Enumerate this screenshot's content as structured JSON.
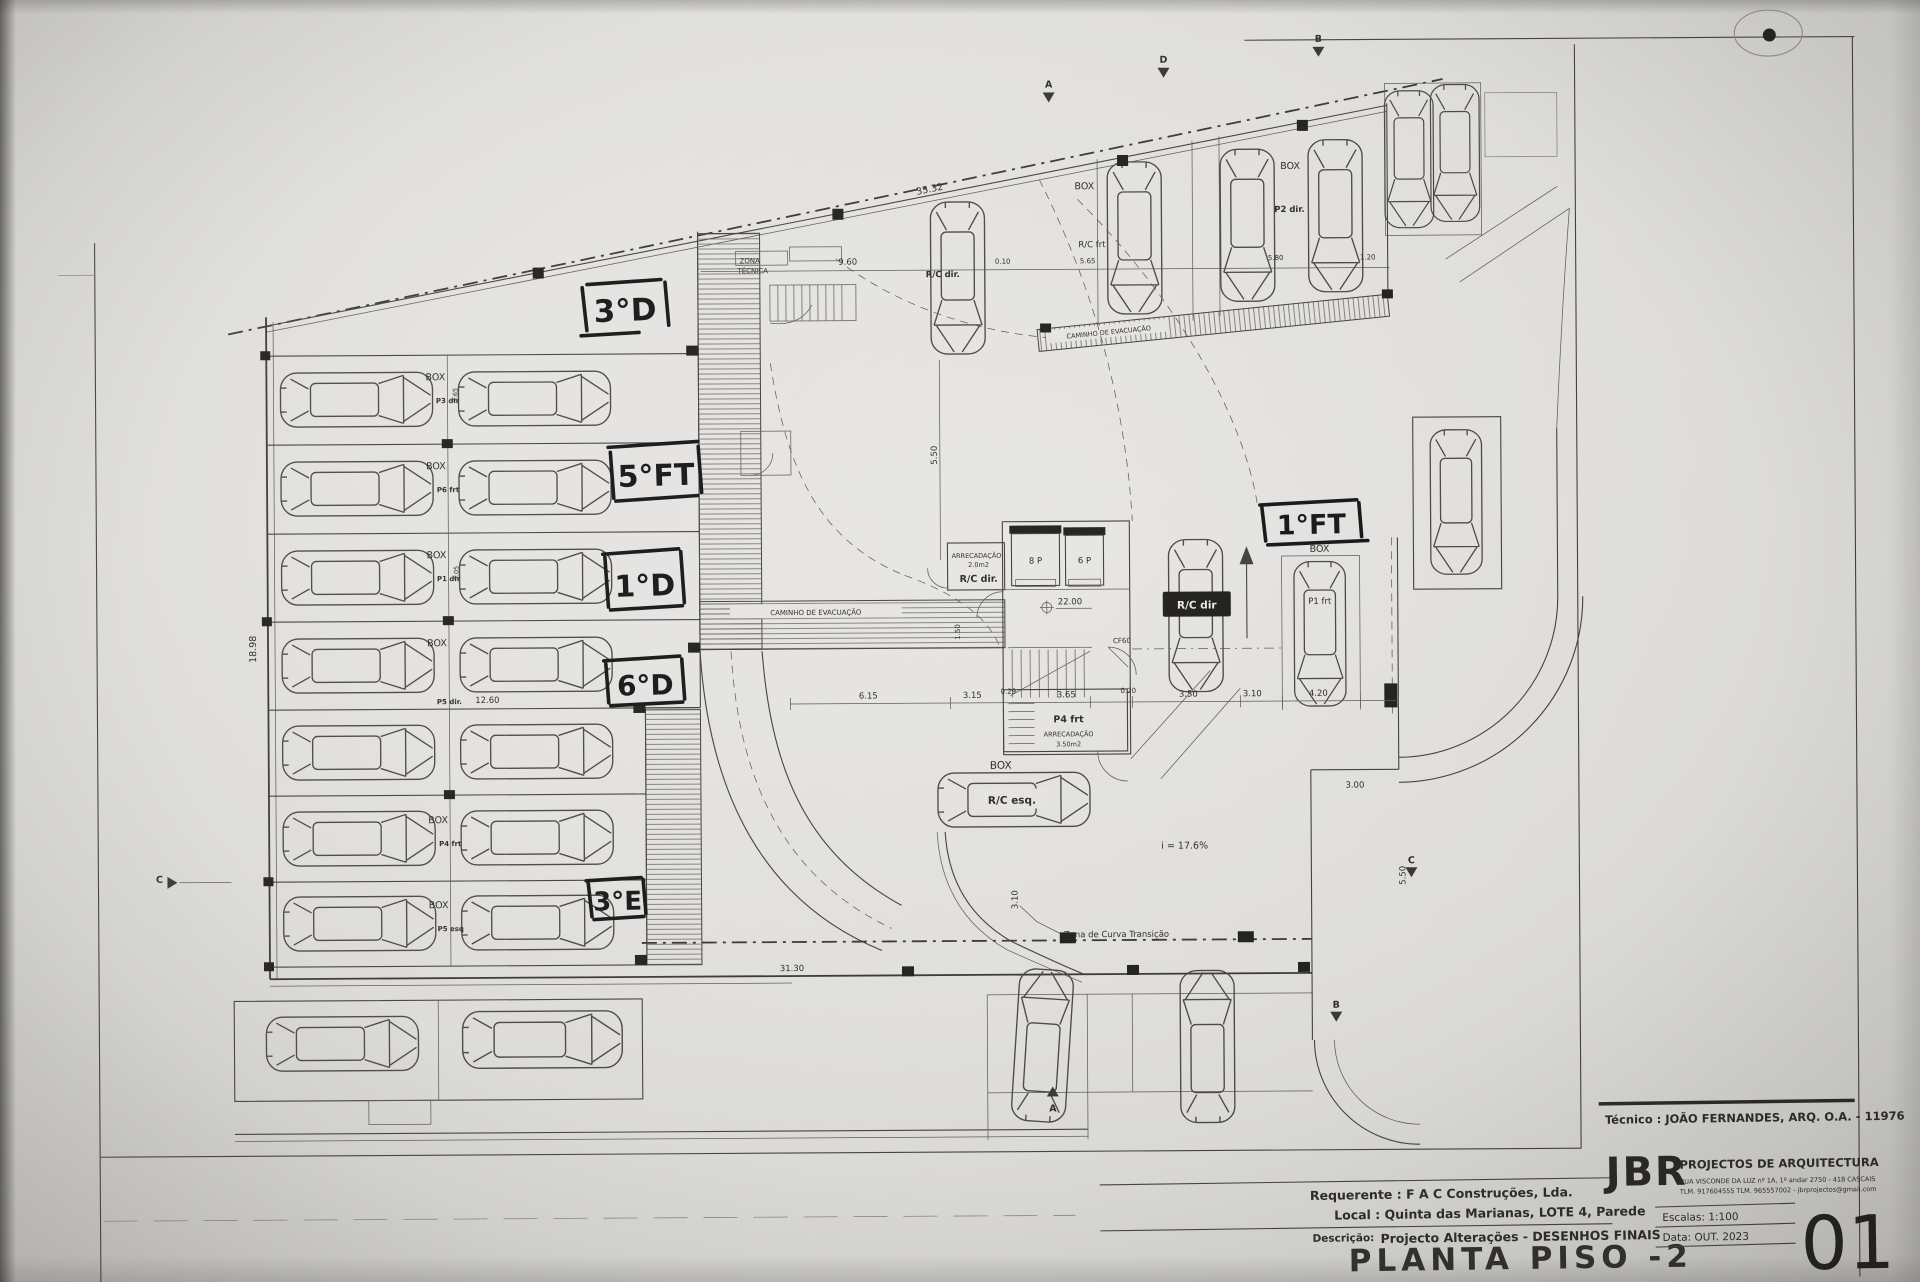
{
  "title_block": {
    "tecnico": "Técnico : JOÃO FERNANDES, ARQ.   O.A. - 11976",
    "firm_name": "JBR",
    "firm_subtitle": "PROJECTOS DE ARQUITECTURA",
    "firm_address": "RUA VISCONDE DA LUZ nº 1A, 1º andar  2750 - 418  CASCAIS",
    "firm_contacts": "TLM. 917604555  TLM. 965557002 - jbrprojectos@gmail.com",
    "requerente": "Requerente : F A C  Construções, Lda.",
    "local": "Local : Quinta das Marianas, LOTE 4, Parede",
    "descricao_label": "Descrição:",
    "descricao": "Projecto Alterações - DESENHOS FINAIS",
    "sheet_title": "PLANTA PISO -2",
    "escalas": "Escalas:  1:100",
    "data": "Data: OUT.  2023",
    "sheet_number": "01"
  },
  "handwritten": {
    "n1": "3°D",
    "n2": "5°FT",
    "n3": "1°D",
    "n4": "6°D",
    "n5": "3°E",
    "n6": "1°FT"
  },
  "labels": {
    "box": "BOX",
    "zona1": "ZONA",
    "zona2": "TÉCNICA",
    "caminho": "CAMINHO  DE  EVACUAÇÃO",
    "rc_dir": "R/C dir.",
    "rc_frt": "R/C frt",
    "p2_dir": "P2 dir.",
    "arrecadacao": "ARRECADAÇÃO",
    "arrec_area_small": "2.0m2",
    "arrec_area_big": "3.50m2",
    "lift8": "8 P",
    "lift6": "6 P",
    "level": "22.00",
    "cf60": "CF60",
    "p4_frt": "P4 frt",
    "rc_dir_car": "R/C dir",
    "p1_frt": "P1 frt",
    "rc_esq": "R/C esq.",
    "incline": "i = 17.6%",
    "curva": "Zona de Curva Transição"
  },
  "stalls": {
    "p3": "P3 dir",
    "p6": "P6 frt",
    "p1": "P1 dir",
    "p5d": "P5 dir.",
    "p4f": "P4 frt",
    "p5e": "P5 esq"
  },
  "dims": {
    "d3532": "35.32",
    "d960": "9.60",
    "d565": "5.65",
    "d010": "0.10",
    "d580": "5.80",
    "d120": "1.20",
    "d1260": "12.60",
    "d1898": "18.98",
    "d3130": "31.30",
    "d615": "6.15",
    "d315": "3.15",
    "d029": "0.29",
    "d365": "3.65",
    "d020": "0.20",
    "d350": "3.50",
    "d310": "3.10",
    "d420": "4.20",
    "d300": "3.00",
    "d550": "5.50",
    "d150": "1.50",
    "d305": "3.05"
  },
  "markers": {
    "a": "A",
    "b": "B",
    "c": "C",
    "d": "D"
  }
}
